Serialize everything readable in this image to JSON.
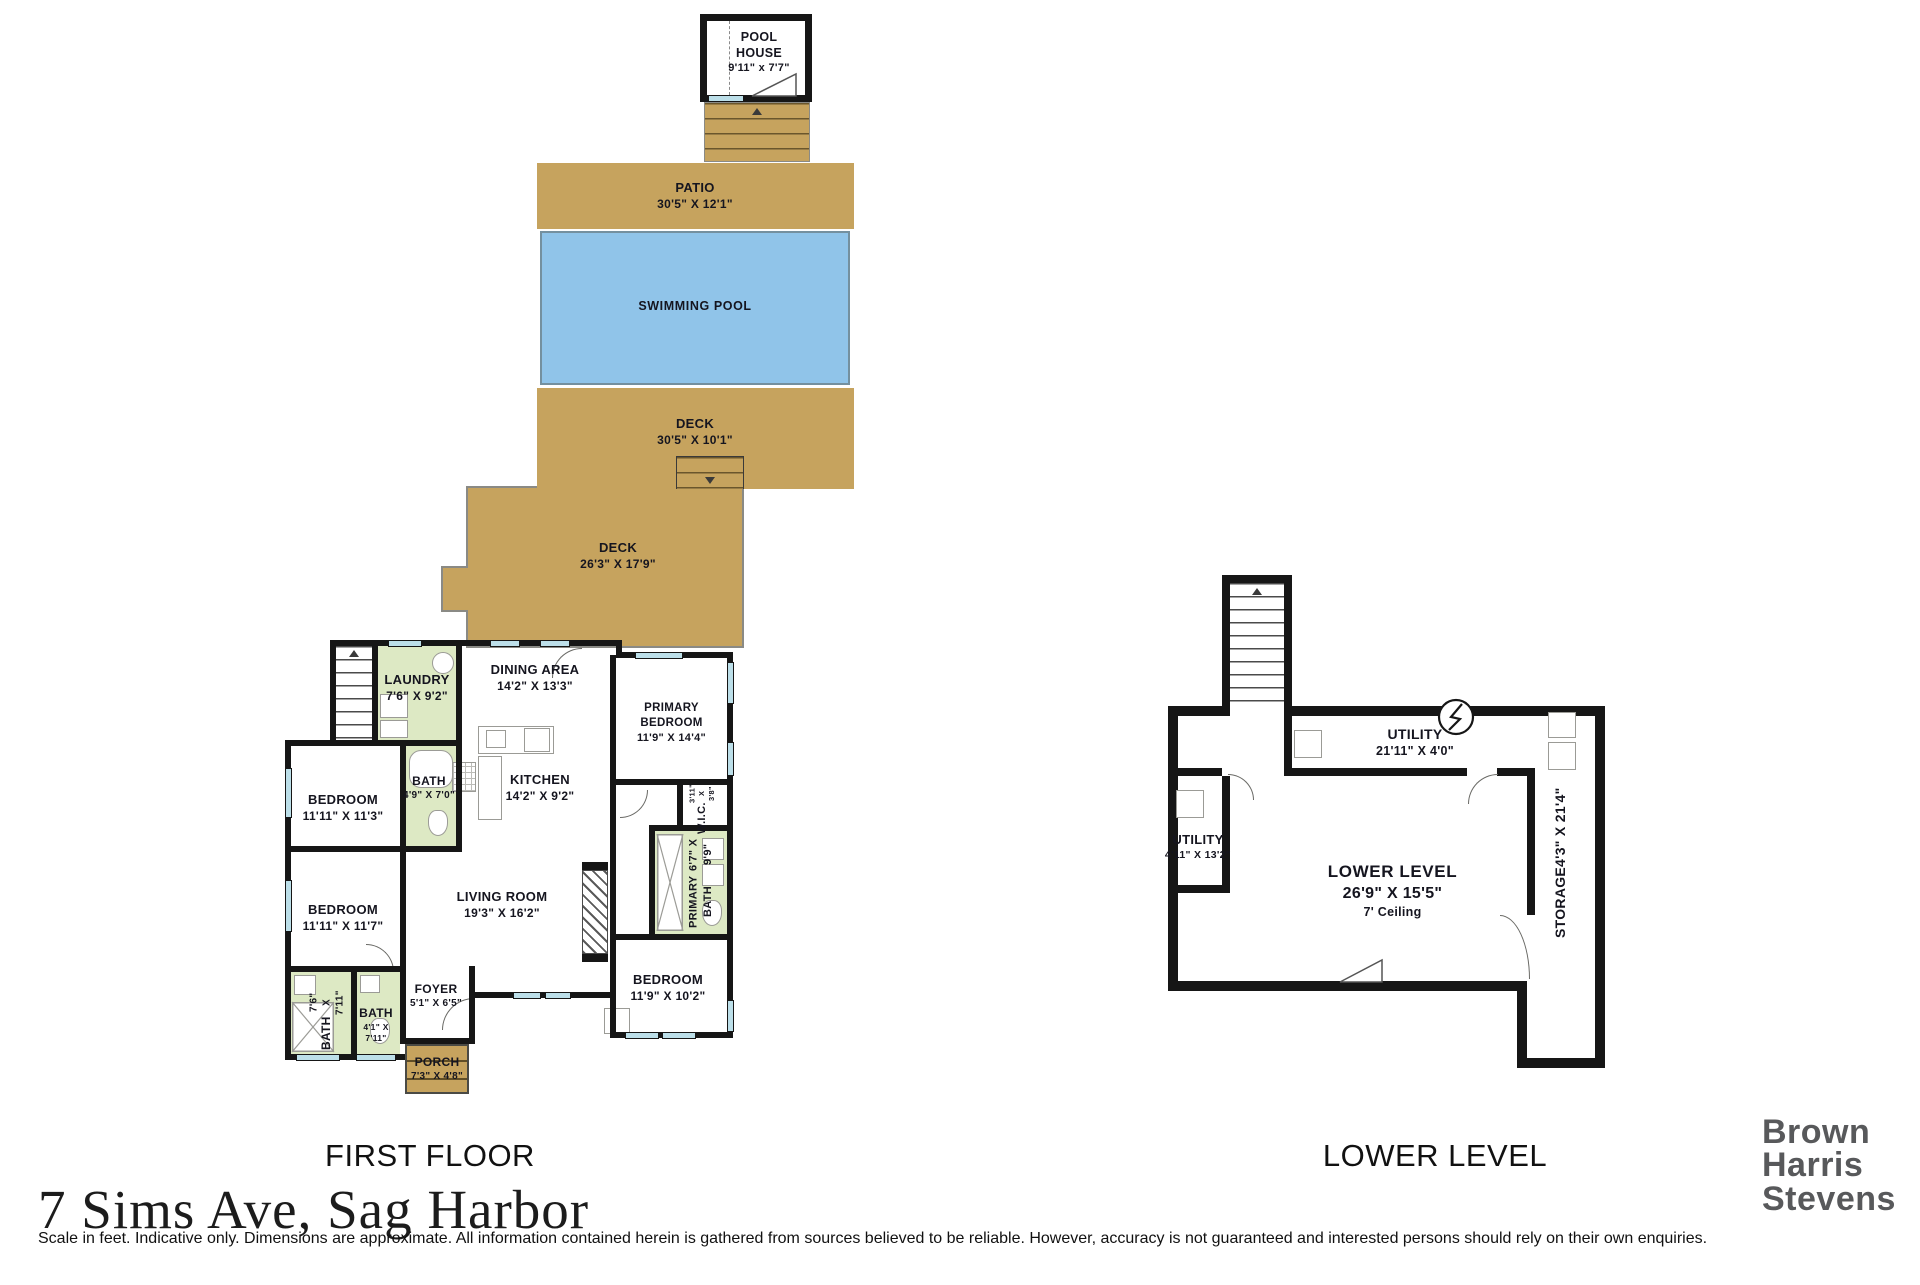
{
  "page": {
    "address": "7 Sims Ave, Sag Harbor",
    "disclaimer": "Scale in feet. Indicative only. Dimensions are approximate. All information contained herein is gathered from sources believed to be reliable. However, accuracy is not guaranteed and interested persons should rely on their own enquiries."
  },
  "branding": {
    "lines": [
      "Brown",
      "Harris",
      "Stevens"
    ]
  },
  "colors": {
    "deck_tan": "#c6a35e",
    "pool_blue": "#90c4e9",
    "bath_green": "#dde9c4",
    "wall_black": "#161616",
    "window_blue": "#bcdfe9",
    "logo_gray": "#58595b"
  },
  "first_floor": {
    "caption": "FIRST FLOOR",
    "outdoor": {
      "pool_house": {
        "name": "POOL HOUSE",
        "dims": "9'11\" x 7'7\""
      },
      "patio": {
        "name": "PATIO",
        "dims": "30'5\" X 12'1\""
      },
      "swimming_pool": {
        "name": "SWIMMING POOL"
      },
      "deck_upper": {
        "name": "DECK",
        "dims": "30'5\" X 10'1\""
      },
      "deck_lower": {
        "name": "DECK",
        "dims": "26'3\" X 17'9\""
      },
      "porch": {
        "name": "PORCH",
        "dims": "7'3\" X 4'8\""
      }
    },
    "rooms": {
      "laundry": {
        "name": "LAUNDRY",
        "dims": "7'6\" X 9'2\""
      },
      "dining": {
        "name": "DINING AREA",
        "dims": "14'2\" X 13'3\""
      },
      "primary_bedroom": {
        "name": "PRIMARY BEDROOM",
        "dims": "11'9\" X 14'4\""
      },
      "bedroom1": {
        "name": "BEDROOM",
        "dims": "11'11\" X 11'3\""
      },
      "bath1": {
        "name": "BATH",
        "dims": "4'9\" X 7'0\""
      },
      "kitchen": {
        "name": "KITCHEN",
        "dims": "14'2\" X 9'2\""
      },
      "wic": {
        "name": "W.I.C.",
        "dims": "3'11\" X 3'8\""
      },
      "primary_bath": {
        "name": "PRIMARY BATH",
        "dims": "6'7\" X 9'9\""
      },
      "bedroom2": {
        "name": "BEDROOM",
        "dims": "11'11\" X 11'7\""
      },
      "living": {
        "name": "LIVING ROOM",
        "dims": "19'3\" X 16'2\""
      },
      "bedroom3": {
        "name": "BEDROOM",
        "dims": "11'9\" X 10'2\""
      },
      "foyer": {
        "name": "FOYER",
        "dims": "5'1\" X 6'5\""
      },
      "bath2": {
        "name": "BATH",
        "dims": "7'6\" X 7'11\""
      },
      "bath3": {
        "name": "BATH",
        "dims": "4'1\" X 7'11\""
      }
    }
  },
  "lower_level": {
    "caption": "LOWER LEVEL",
    "rooms": {
      "utility_top": {
        "name": "UTILITY",
        "dims": "21'11\" X 4'0\""
      },
      "utility_left": {
        "name": "UTILITY",
        "dims": "4'11\" X 13'2\""
      },
      "main": {
        "name": "LOWER LEVEL",
        "dims": "26'9\" X 15'5\"",
        "note": "7' Ceiling"
      },
      "storage": {
        "name": "STORAGE",
        "dims": "4'3\" X 21'4\""
      }
    }
  }
}
